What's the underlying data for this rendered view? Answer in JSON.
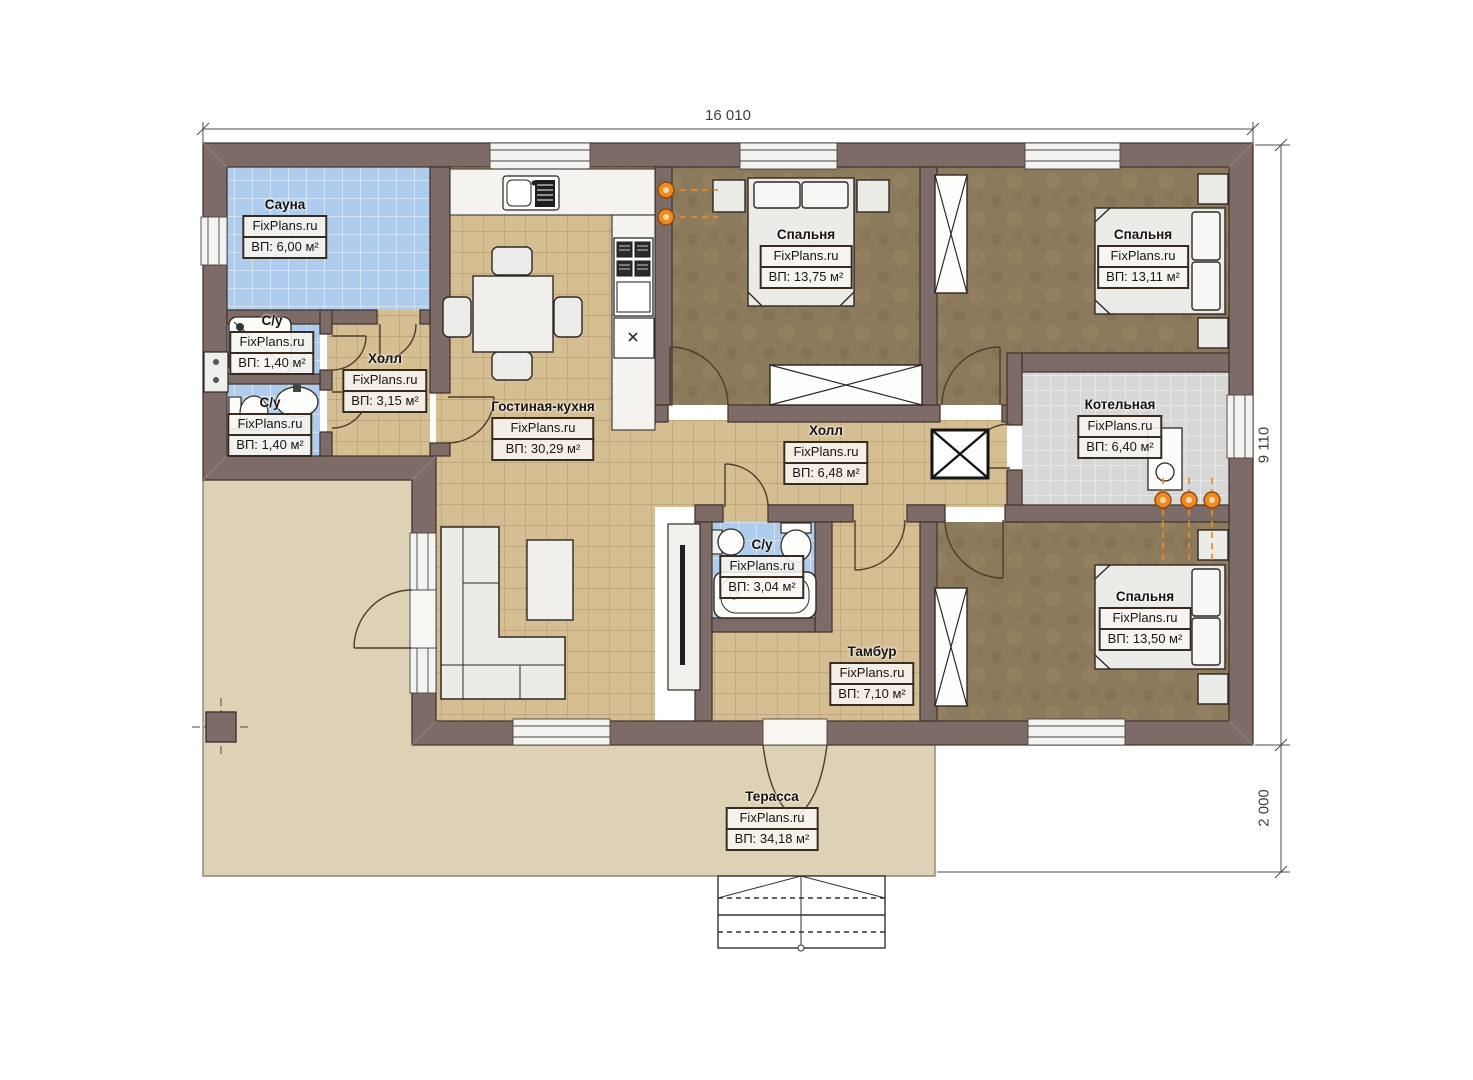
{
  "plan": {
    "brand_watermark": "FixPlans.ru",
    "dimensions": {
      "top_width": "16 010",
      "right_height": "9 110",
      "terrace_depth": "2 000"
    },
    "rooms": [
      {
        "id": "sauna",
        "name": "Сауна",
        "brand": "FixPlans.ru",
        "area": "ВП: 6,00 м²"
      },
      {
        "id": "wc-top",
        "name": "С/у",
        "brand": "FixPlans.ru",
        "area": "ВП: 1,40 м²"
      },
      {
        "id": "wc-bottom",
        "name": "С/у",
        "brand": "FixPlans.ru",
        "area": "ВП: 1,40 м²"
      },
      {
        "id": "hall-small",
        "name": "Холл",
        "brand": "FixPlans.ru",
        "area": "ВП: 3,15 м²"
      },
      {
        "id": "living-kitchen",
        "name": "Гостиная-кухня",
        "brand": "FixPlans.ru",
        "area": "ВП: 30,29 м²"
      },
      {
        "id": "bedroom-1",
        "name": "Спальня",
        "brand": "FixPlans.ru",
        "area": "ВП: 13,75 м²"
      },
      {
        "id": "bedroom-2",
        "name": "Спальня",
        "brand": "FixPlans.ru",
        "area": "ВП: 13,11 м²"
      },
      {
        "id": "hall-center",
        "name": "Холл",
        "brand": "FixPlans.ru",
        "area": "ВП: 6,48 м²"
      },
      {
        "id": "boiler-room",
        "name": "Котельная",
        "brand": "FixPlans.ru",
        "area": "ВП: 6,40 м²"
      },
      {
        "id": "wc-center",
        "name": "С/у",
        "brand": "FixPlans.ru",
        "area": "ВП: 3,04 м²"
      },
      {
        "id": "tambour",
        "name": "Тамбур",
        "brand": "FixPlans.ru",
        "area": "ВП: 7,10 м²"
      },
      {
        "id": "bedroom-3",
        "name": "Спальня",
        "brand": "FixPlans.ru",
        "area": "ВП: 13,50 м²"
      },
      {
        "id": "terrace",
        "name": "Терасса",
        "brand": "FixPlans.ru",
        "area": "ВП: 34,18 м²"
      }
    ],
    "colors": {
      "wall": "#7d6b68",
      "floor_wood": "#d6be93",
      "floor_tile_blue": "#aecdee",
      "floor_tile_gray": "#d7d7d7",
      "floor_bedroom": "#8c7a5c",
      "terrace": "#ddd2b5",
      "radiator": "#f08a20"
    }
  }
}
